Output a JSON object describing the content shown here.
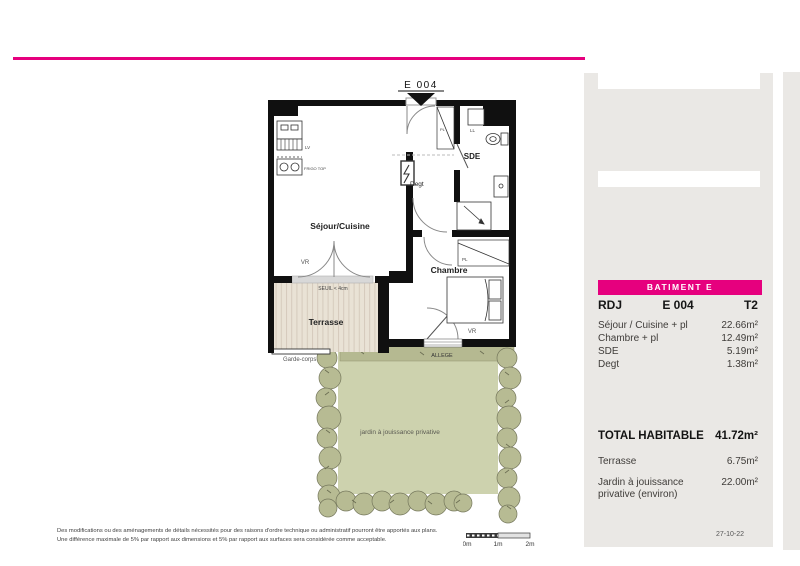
{
  "accent_color": "#e6007e",
  "plan": {
    "unit_tag": "E 004",
    "labels": {
      "sejour": "Séjour/Cuisine",
      "chambre": "Chambre",
      "sde": "SDE",
      "degt": "Degt",
      "terrasse": "Terrasse",
      "seuil": "SEUIL < 4cm",
      "vr_sejour": "VR",
      "vr_chambre": "VR",
      "lv": "LV",
      "frigo": "FRIGO TOP",
      "ll": "LL",
      "pl_entry": "PL",
      "pl_chambre": "PL",
      "garde_corps": "Garde-corps",
      "allege": "ALLEGE",
      "jardin": "jardin à jouissance privative"
    }
  },
  "panel": {
    "batiment": "BATIMENT E",
    "level": "RDJ",
    "unit": "E 004",
    "type": "T2",
    "rooms": [
      {
        "label": "Séjour / Cuisine + pl",
        "area": "22.66m²"
      },
      {
        "label": "Chambre + pl",
        "area": "12.49m²"
      },
      {
        "label": "SDE",
        "area": "5.19m²"
      },
      {
        "label": "Degt",
        "area": "1.38m²"
      }
    ],
    "total": {
      "label": "TOTAL HABITABLE",
      "area": "41.72m²"
    },
    "extras": [
      {
        "label": "Terrasse",
        "area": "6.75m²"
      },
      {
        "label": "Jardin à jouissance privative (environ)",
        "area": "22.00m²"
      }
    ],
    "date": "27-10-22"
  },
  "footer": {
    "disclaimer1": "Des modifications ou des aménagements de détails nécessités pour des raisons d'ordre technique ou administratif pourront être apportés aux plans.",
    "disclaimer2": "Une différence maximale de 5% par rapport aux dimensions et 5% par rapport aux surfaces sera considérée comme acceptable.",
    "scale_ticks": [
      "0m",
      "1m",
      "2m"
    ]
  }
}
